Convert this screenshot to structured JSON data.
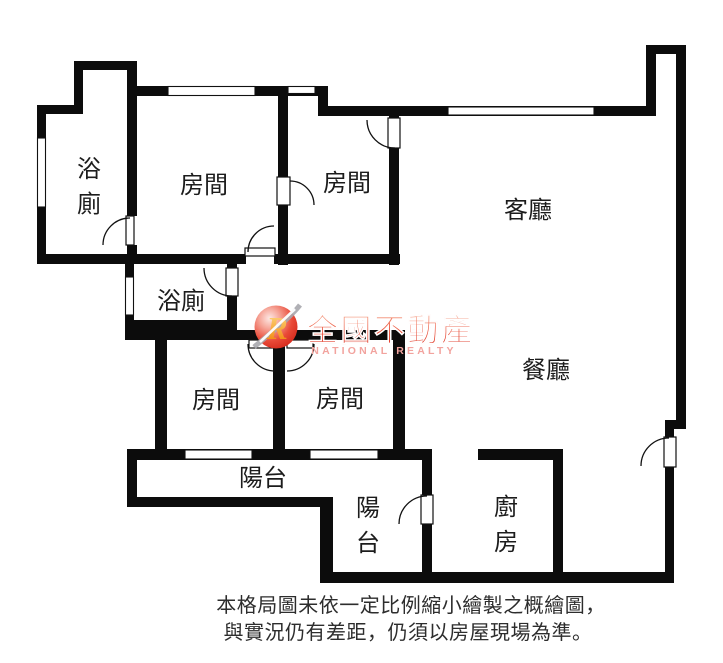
{
  "floorplan": {
    "rooms": {
      "bath1": {
        "label": "浴廁",
        "orientation": "vertical"
      },
      "bedroom_top1": {
        "label": "房間"
      },
      "bedroom_top2": {
        "label": "房間"
      },
      "living": {
        "label": "客廳"
      },
      "bath2": {
        "label": "浴廁"
      },
      "dining": {
        "label": "餐廳"
      },
      "bedroom_low1": {
        "label": "房間"
      },
      "bedroom_low2": {
        "label": "房間"
      },
      "balcony1": {
        "label": "陽台"
      },
      "balcony2": {
        "label": "陽台",
        "orientation": "vertical"
      },
      "kitchen": {
        "label": "廚房",
        "orientation": "vertical"
      }
    },
    "watermark": {
      "logo_letter": "R",
      "brand": "全國不動產",
      "brand_en": "NATIONAL REALTY",
      "colors": {
        "brand_red_top": "#f59a7c",
        "brand_red_bottom": "#da2312",
        "brand_pink": "#f2a39e",
        "logo_ball_red": "#e94a38",
        "logo_r_orange": "#ef7d00"
      }
    },
    "disclaimer": {
      "line1": "本格局圖未依一定比例縮小繪製之概繪圖，",
      "line2": "與實況仍有差距，仍須以房屋現場為準。"
    },
    "wall_color": "#0c0c0c"
  }
}
